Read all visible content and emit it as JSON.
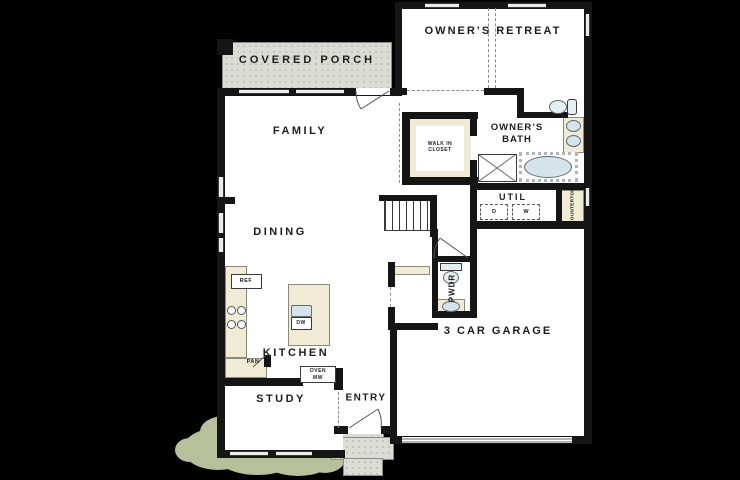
{
  "colors": {
    "background": "#000000",
    "wall": "#151515",
    "room": "#ffffff",
    "porch": "#dcdcd6",
    "counter": "#f1ead4",
    "fixture": "#d5e3ea",
    "bush": "#b6c19b"
  },
  "labels": {
    "covered_porch": "COVERED PORCH",
    "owners_retreat": "OWNER’S RETREAT",
    "family": "FAMILY",
    "dining": "DINING",
    "kitchen": "KITCHEN",
    "study": "STUDY",
    "entry": "ENTRY",
    "garage": "3 CAR GARAGE",
    "owners_bath": "OWNER’S BATH",
    "walk_in_closet": "WALK IN CLOSET",
    "util": "UTIL",
    "pwdr": "PWDR",
    "countertop": "COUNTERTOP",
    "ref": "REF",
    "pan": "PAN",
    "dw": "DW",
    "oven": "OVEN",
    "mw": "MW",
    "dryer": "D",
    "washer": "W"
  }
}
